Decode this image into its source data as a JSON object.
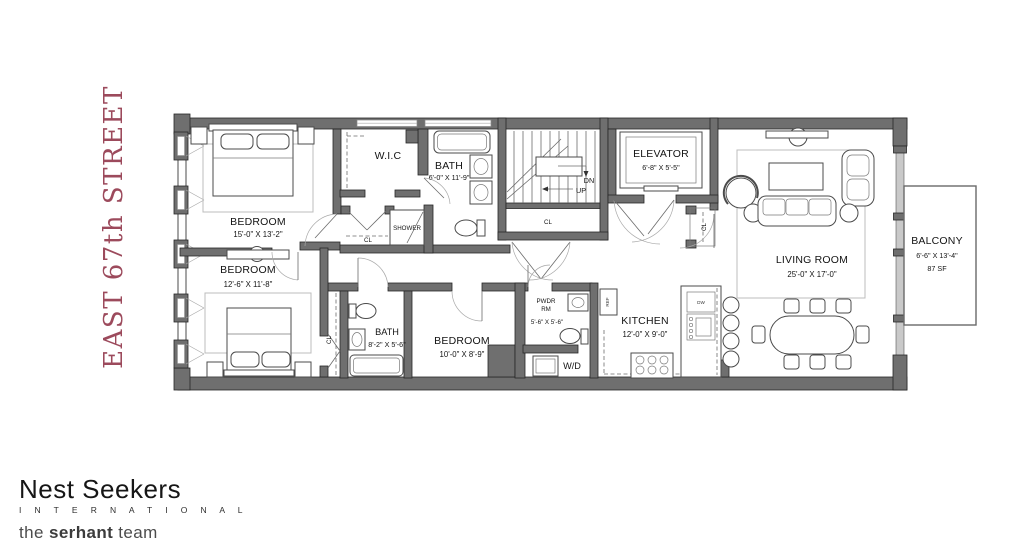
{
  "street_label": "EAST 67th STREET",
  "brand": {
    "name": "Nest Seekers",
    "subtitle": "I N T E R N A T I O N A L",
    "team_pre": "the ",
    "team_bold": "serhant",
    "team_post": " team"
  },
  "labels": {
    "closet": "CL",
    "shower": "SHOWER",
    "down": "DN",
    "up": "UP",
    "washer_dryer": "W/D",
    "fridge": "REF",
    "dishwasher": "DW"
  },
  "rooms": {
    "bedroom_master": {
      "name": "BEDROOM",
      "dims": "15'-0\" X 13'-2\""
    },
    "bedroom_second": {
      "name": "BEDROOM",
      "dims": "12'-6\" X 11'-8\""
    },
    "bedroom_third": {
      "name": "BEDROOM",
      "dims": "10'-0\" X 8'-9\""
    },
    "wic": {
      "name": "W.I.C"
    },
    "bath_upper": {
      "name": "BATH",
      "dims": "6'-0\" X 11'-9\""
    },
    "bath_lower": {
      "name": "BATH",
      "dims": "8'-2\" X 5'-6\""
    },
    "powder": {
      "name_line1": "PWDR",
      "name_line2": "RM",
      "dims": "5'-6\" X 5'-6\""
    },
    "kitchen": {
      "name": "KITCHEN",
      "dims": "12'-0\" X 9'-0\""
    },
    "elevator": {
      "name": "ELEVATOR",
      "dims": "6'-8\" X 5'-5\""
    },
    "living_room": {
      "name": "LIVING ROOM",
      "dims": "25'-0\" X 17'-0\""
    },
    "balcony": {
      "name": "BALCONY",
      "dims": "6'-6\" X 13'-4\"",
      "area": "87 SF"
    }
  },
  "colors": {
    "wall": "#6f6f6f",
    "street_text": "#9c4a5c",
    "glass": "#c9c9c9"
  }
}
